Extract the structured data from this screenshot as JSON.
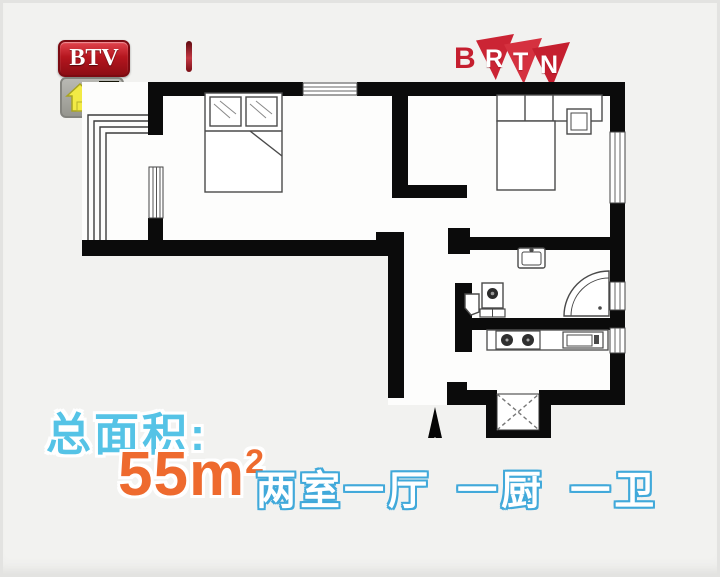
{
  "channel_bug": {
    "name": "BTV",
    "badge_char_top": "高",
    "badge_char_bottom": "温"
  },
  "network_logo": {
    "letter_b": "B",
    "letter_r": "R",
    "letter_t": "T",
    "letter_n": "N"
  },
  "caption": {
    "label": "总面积:",
    "area_value": "55",
    "area_unit": "m",
    "area_exponent": "2",
    "layout": "两室一厅 一厨 一卫"
  },
  "colors": {
    "caption_label_blue": "#55c3e6",
    "area_orange": "#ee6a2e",
    "layout_outline_blue": "#41a9da",
    "logo_red": "#c51f2f",
    "badge_yellow": "#f2e935",
    "wall_black": "#0b0b0b"
  },
  "floor_plan": {
    "elements": [
      "double-bed-left",
      "pillows",
      "double-bed-right",
      "headboard-cabinet",
      "nightstand",
      "washbasin",
      "toilet",
      "washing-machine",
      "corner-shower",
      "gas-stove",
      "kitchen-sink",
      "kitchen-counter",
      "duct-shaft-x",
      "entrance-arrow",
      "balcony-window-lines",
      "window-top",
      "window-right-bedroom",
      "window-bathroom",
      "window-kitchen",
      "window-left"
    ]
  }
}
